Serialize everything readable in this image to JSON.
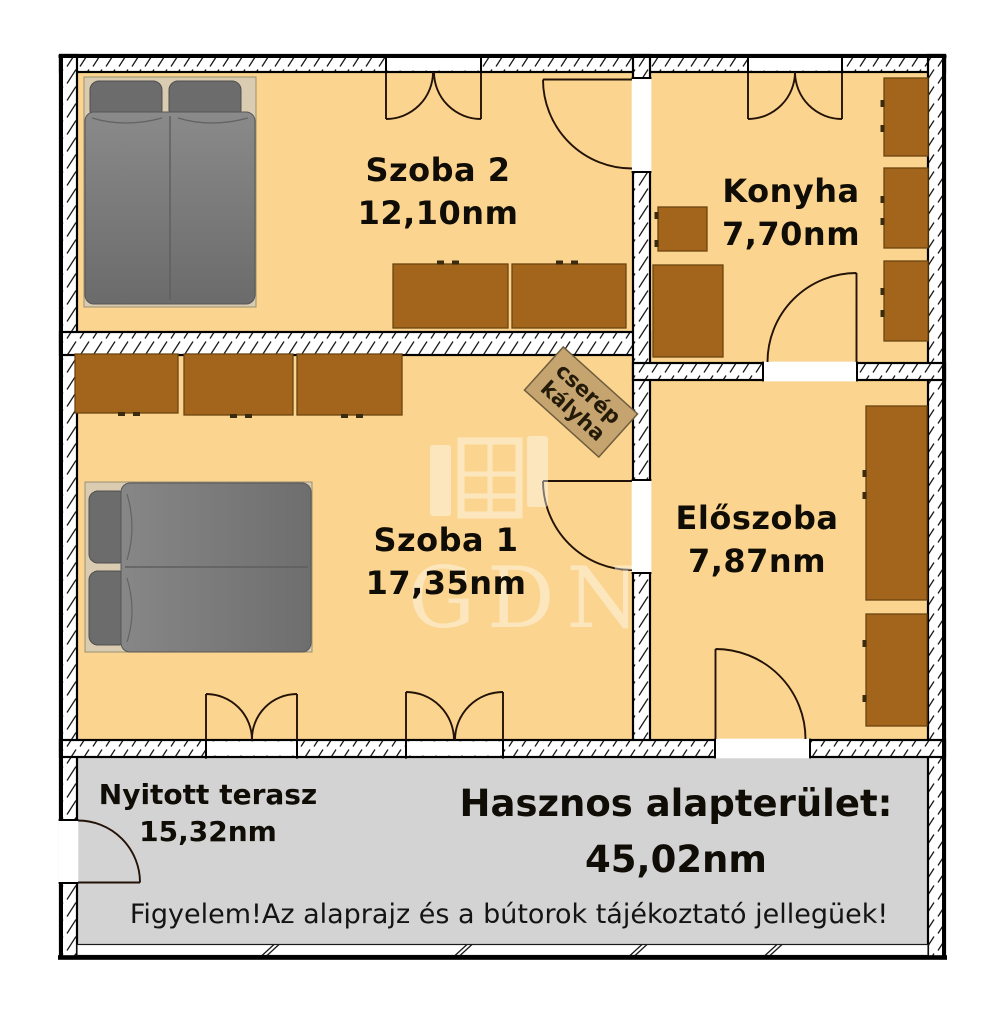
{
  "rooms": {
    "szoba2": {
      "name": "Szoba 2",
      "area": "12,10nm"
    },
    "konyha": {
      "name": "Konyha",
      "area": "7,70nm"
    },
    "szoba1": {
      "name": "Szoba 1",
      "area": "17,35nm"
    },
    "eloszoba": {
      "name": "Előszoba",
      "area": "7,87nm"
    },
    "terasz": {
      "name": "Nyitott terasz",
      "area": "15,32nm"
    }
  },
  "stove": {
    "line1": "cserép",
    "line2": "kályha"
  },
  "summary": {
    "label": "Hasznos alapterület:",
    "value": "45,02nm"
  },
  "disclaimer": "Figyelem!Az alaprajz és a bútorok tájékoztató jellegüek!",
  "watermark": {
    "text": "GDN"
  },
  "colors": {
    "floor": "#FBD58F",
    "terrace": "#D3D3D3",
    "cabinet": "#A2651B",
    "cabinet_border": "#6B4410",
    "stove_fill": "#C5A470",
    "bed_blanket": "#7A7A7A",
    "bed_pillow": "#6C6C6C",
    "bed_frame": "#D9CCB1",
    "wall_line": "#000000",
    "text": "#100d07"
  }
}
